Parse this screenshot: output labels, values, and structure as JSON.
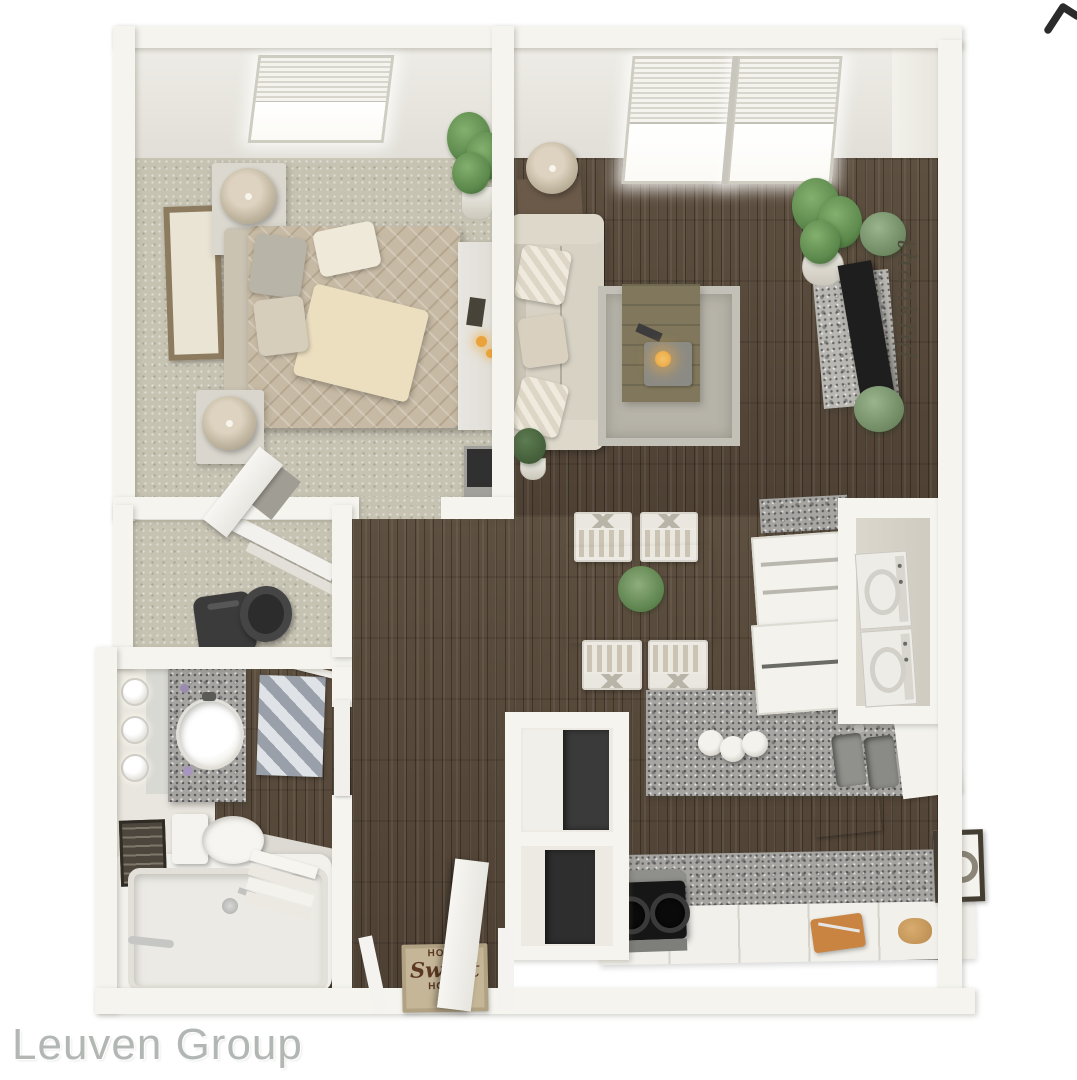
{
  "watermark": {
    "text": "Leuven Group"
  },
  "icons": {
    "corner": "chevron-right-icon"
  },
  "wall_decor": {
    "script_text": "thankful"
  },
  "entry_mat": {
    "line1": "HOME",
    "line2": "Sweet",
    "line3": "HOME"
  },
  "colors": {
    "background": "#ffffff",
    "wall": "#f5f4ef",
    "wood": "#4e4134",
    "wood_light": "#5e5040",
    "carpet": "#c7c3b3",
    "granite": "#a6a5a1",
    "sofa": "#d7d2c4",
    "bed": "#c7baa4",
    "rug": "#b6b3a9",
    "flame": "#eaa33c",
    "plant": "#5d8a4d",
    "plant_dark": "#3c6131",
    "tv": "#1e1e1e",
    "appliance": "#161616",
    "mat": "#c6b698",
    "mat_text": "#5a3823",
    "script_text": "#4f493c",
    "watermark": "#b2b7b4",
    "chevron": "#2b2b2b",
    "curtain_b": "#dfe2e6",
    "cube_a": "#5f616b",
    "cube_b": "#9aa0aa"
  }
}
